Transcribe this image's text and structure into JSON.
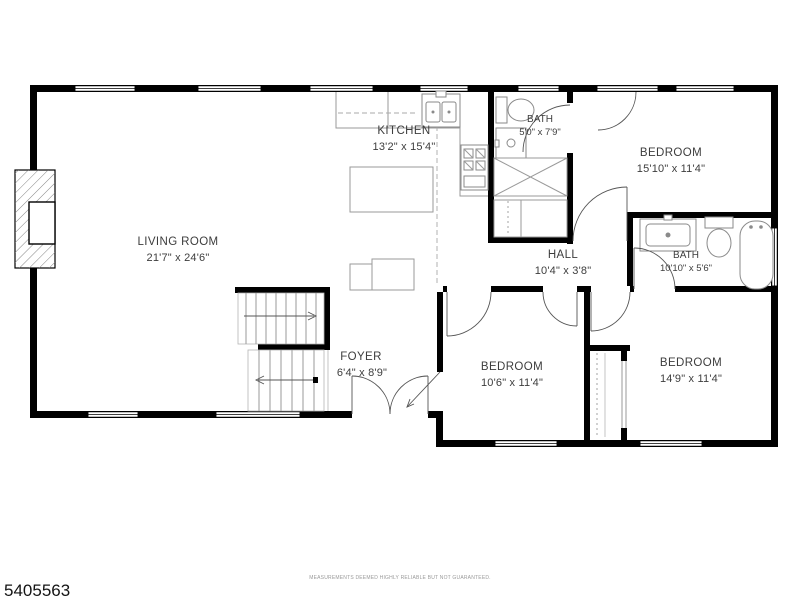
{
  "floorplan": {
    "mls_number": "5405563",
    "disclaimer": "MEASUREMENTS DEEMED HIGHLY RELIABLE BUT NOT GUARANTEED.",
    "rooms": {
      "living_room": {
        "name": "LIVING ROOM",
        "dimensions": "21'7\" x 24'6\""
      },
      "kitchen": {
        "name": "KITCHEN",
        "dimensions": "13'2\" x 15'4\""
      },
      "bath_upper": {
        "name": "BATH",
        "dimensions": "5'0\" x 7'9\""
      },
      "bedroom_upper_right": {
        "name": "BEDROOM",
        "dimensions": "15'10\" x 11'4\""
      },
      "hall": {
        "name": "HALL",
        "dimensions": "10'4\" x 3'8\""
      },
      "bath_right": {
        "name": "BATH",
        "dimensions": "10'10\" x 5'6\""
      },
      "foyer": {
        "name": "FOYER",
        "dimensions": "6'4\" x 8'9\""
      },
      "bedroom_lower_middle": {
        "name": "BEDROOM",
        "dimensions": "10'6\" x 11'4\""
      },
      "bedroom_lower_right": {
        "name": "BEDROOM",
        "dimensions": "14'9\" x 11'4\""
      }
    },
    "colors": {
      "wall": "#000000",
      "fixture_line": "#8a8a8a",
      "label_text": "#3d3d3d",
      "disclaimer_text": "#9a9a9a",
      "background": "#ffffff"
    }
  }
}
